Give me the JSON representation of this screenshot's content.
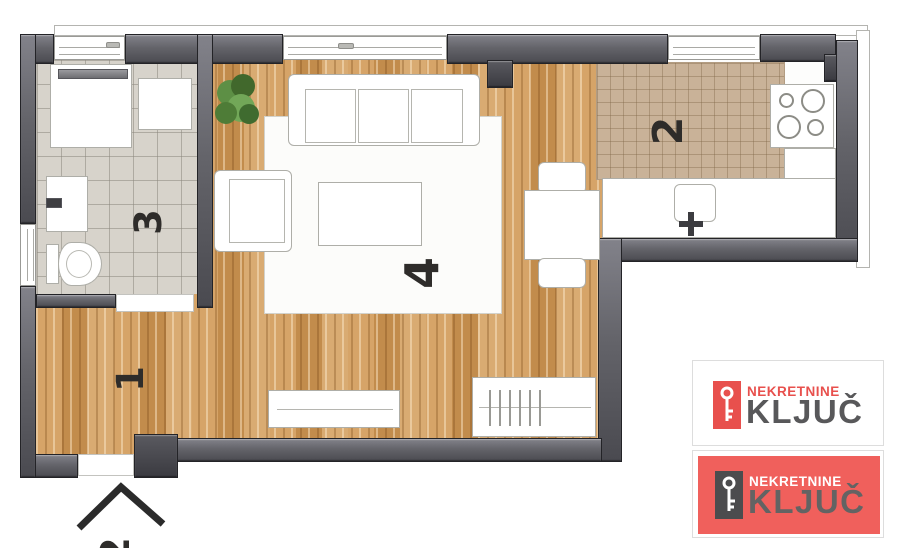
{
  "floorplan": {
    "rooms": {
      "hall": {
        "number": "1"
      },
      "kitchen": {
        "number": "2"
      },
      "bath": {
        "number": "3"
      },
      "living": {
        "number": "4"
      }
    },
    "entrance": {
      "number": "2"
    },
    "colors": {
      "wall_gray": "#64646a",
      "wood_floor": "#cc9557",
      "kitchen_tile": "#c9b298",
      "bath_tile": "#d7d3cb",
      "plant_green": "#5d8f45"
    }
  },
  "branding": {
    "logo_light": {
      "brand": "NEKRETNINE",
      "name": "KLJUČ",
      "brand_color": "#e8504d",
      "name_color": "#58585a"
    },
    "logo_red": {
      "brand": "NEKRETNINE",
      "name": "KLJUČ",
      "bg_color": "#f0605c",
      "name_color": "#636363"
    }
  }
}
